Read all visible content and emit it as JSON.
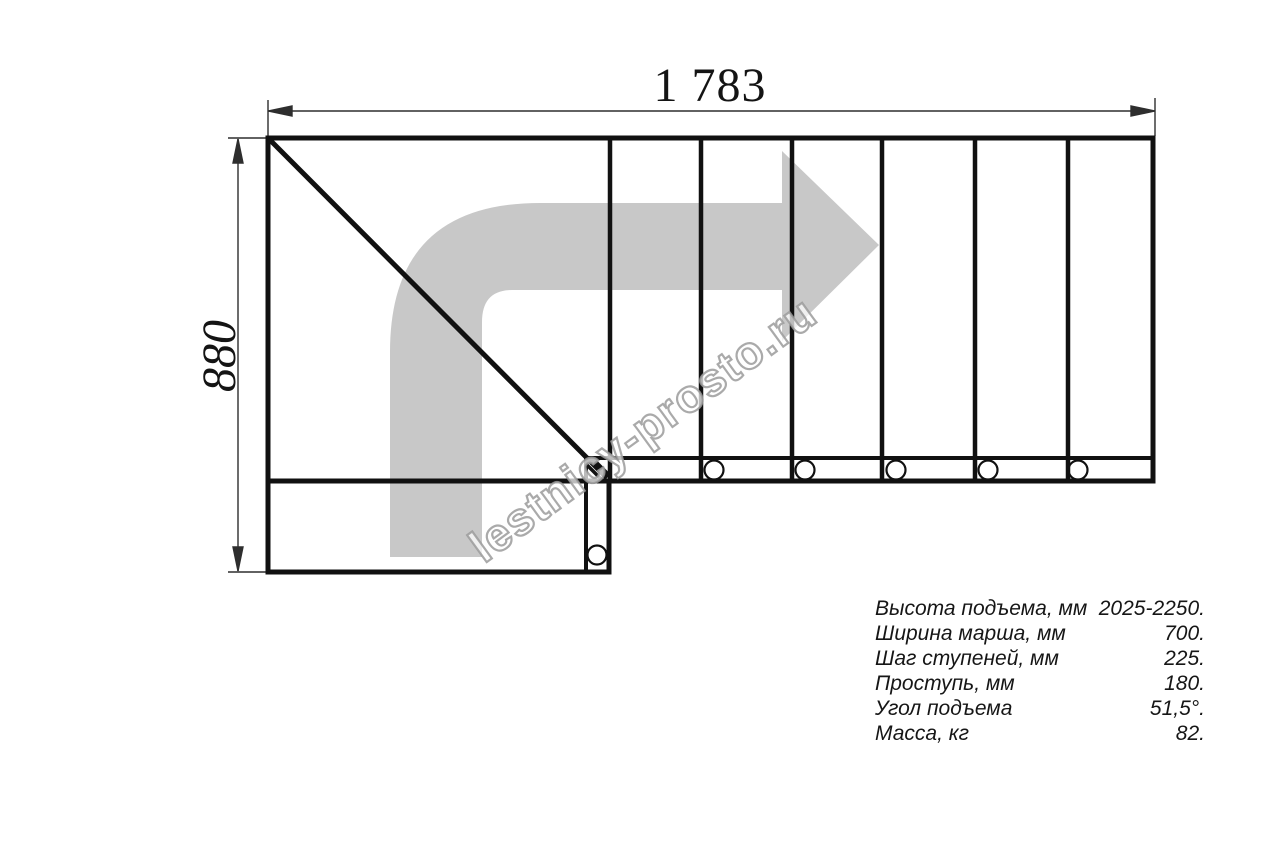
{
  "drawing": {
    "top_dimension_label": "1 783",
    "left_dimension_label": "880",
    "watermark_text": "lestnicy-prosto.ru"
  },
  "specs_table": {
    "rows": [
      {
        "label": "Высота подъема, мм",
        "value": "2025-2250."
      },
      {
        "label": "Ширина марша, мм",
        "value": "700."
      },
      {
        "label": "Шаг ступеней, мм",
        "value": "225."
      },
      {
        "label": "Проступь, мм",
        "value": "180."
      },
      {
        "label": "Угол подъема",
        "value": "51,5°."
      },
      {
        "label": "Масса, кг",
        "value": "82."
      }
    ]
  },
  "colors": {
    "line": "#111111",
    "dimension_line": "#2e2e2e",
    "arrow_fill": "#c8c8c8",
    "watermark_stroke": "#9b9b9b"
  }
}
